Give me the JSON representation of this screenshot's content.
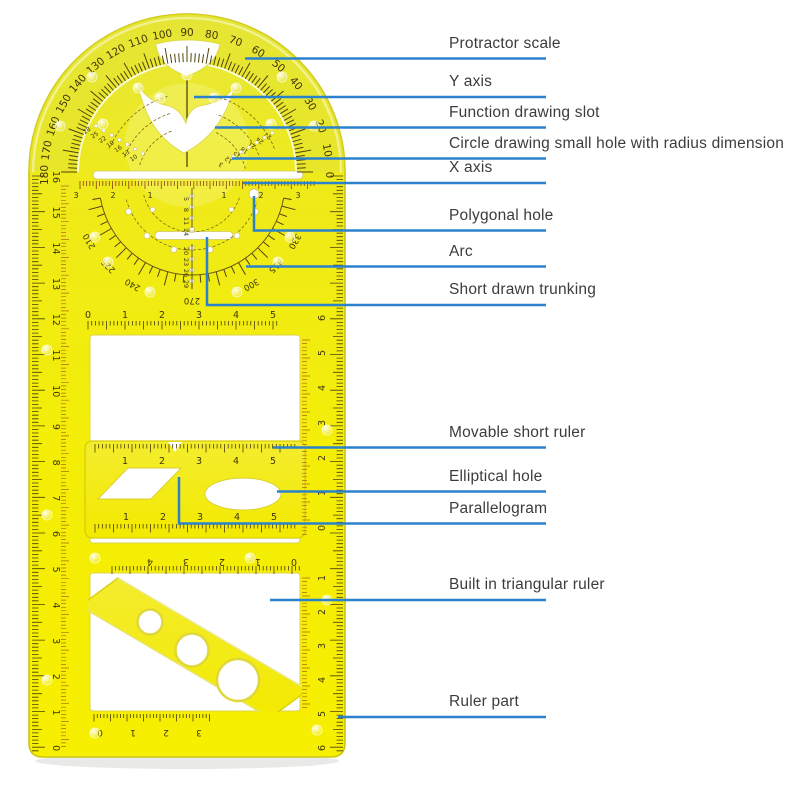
{
  "annotations": {
    "line_color": "#2a82cc",
    "text_color": "#3c3c3c",
    "labels": [
      {
        "id": "protractor-scale",
        "text": "Protractor scale"
      },
      {
        "id": "y-axis",
        "text": "Y axis"
      },
      {
        "id": "function-drawing-slot",
        "text": "Function drawing slot"
      },
      {
        "id": "circle-drawing-hole",
        "text": "Circle drawing small hole with radius dimension"
      },
      {
        "id": "x-axis",
        "text": "X axis"
      },
      {
        "id": "polygonal-hole",
        "text": "Polygonal hole"
      },
      {
        "id": "arc",
        "text": "Arc"
      },
      {
        "id": "short-drawn-trunking",
        "text": "Short drawn trunking"
      },
      {
        "id": "movable-short-ruler",
        "text": "Movable short ruler"
      },
      {
        "id": "elliptical-hole",
        "text": "Elliptical hole"
      },
      {
        "id": "parallelogram",
        "text": "Parallelogram"
      },
      {
        "id": "built-in-triangular-ruler",
        "text": "Built in triangular ruler"
      },
      {
        "id": "ruler-part",
        "text": "Ruler part"
      }
    ]
  },
  "ruler": {
    "body_color": "#f2ec12",
    "protractor_degrees": [
      "0",
      "10",
      "20",
      "30",
      "40",
      "50",
      "60",
      "70",
      "80",
      "90",
      "100",
      "110",
      "120",
      "130",
      "140",
      "150",
      "160",
      "170",
      "180"
    ],
    "dial_degrees": [
      "210",
      "225",
      "240",
      "270",
      "300",
      "315",
      "330"
    ],
    "dial_angles": [
      210,
      225,
      240,
      270,
      300,
      315,
      330
    ],
    "radius_top": [
      "5",
      "8",
      "11",
      "14"
    ],
    "radius_bottom": [
      "20",
      "23",
      "26",
      "29"
    ],
    "curve_left": [
      "28",
      "25",
      "22",
      "19",
      "16",
      "13",
      "10"
    ],
    "curve_right": [
      "3",
      "12",
      "15",
      "18",
      "21",
      "24",
      "27"
    ],
    "x_scale_left": [
      "3",
      "2",
      "1"
    ],
    "x_scale_right": [
      "1",
      "2",
      "3"
    ],
    "top_scale": [
      "0",
      "1",
      "2",
      "3",
      "4",
      "5"
    ],
    "bar_scale_top": [
      "1",
      "2",
      "3",
      "4",
      "5"
    ],
    "bar_scale_bottom": [
      "1",
      "2",
      "3",
      "4",
      "5"
    ],
    "mirror_scale": [
      "4",
      "3",
      "2",
      "1",
      "0"
    ],
    "bottom_inner_scale": [
      "0",
      "1",
      "2",
      "3"
    ],
    "left_edge": [
      "16",
      "15",
      "14",
      "13",
      "12",
      "11",
      "10",
      "9",
      "8",
      "7",
      "6",
      "5",
      "4",
      "3",
      "2",
      "1",
      "0"
    ],
    "right_edge_top": [
      "6",
      "5",
      "4",
      "3",
      "2",
      "1",
      "0"
    ],
    "right_edge_bottom": [
      "1",
      "2",
      "3",
      "4",
      "5",
      "6"
    ]
  }
}
